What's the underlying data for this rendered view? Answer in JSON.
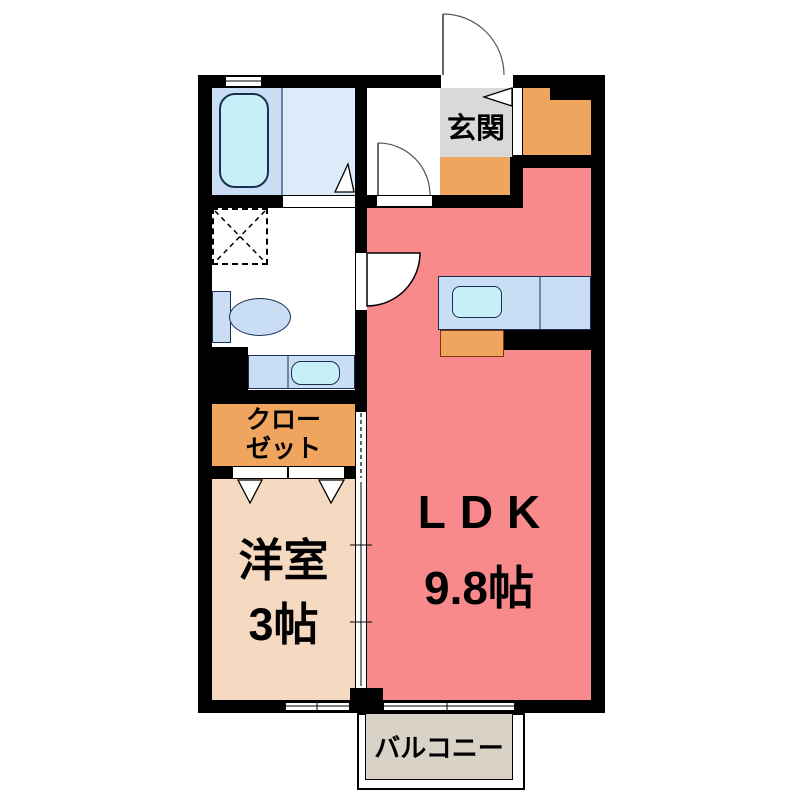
{
  "floorplan": {
    "labels": {
      "entrance": "玄関",
      "closet_line1": "クロー",
      "closet_line2": "ゼット",
      "western_line1": "洋室",
      "western_line2": "3帖",
      "ldk_line1": "LDK",
      "ldk_line2": "9.8帖",
      "balcony": "バルコニー"
    },
    "rooms": [
      {
        "name": "玄関"
      },
      {
        "name": "クローゼット"
      },
      {
        "name": "洋室",
        "size": "3帖"
      },
      {
        "name": "LDK",
        "size": "9.8帖"
      },
      {
        "name": "バルコニー"
      }
    ],
    "fixtures": [
      "bathtub",
      "washing-machine-pan",
      "toilet",
      "washbasin",
      "kitchen-counter",
      "kitchen-sink",
      "shoe-storage",
      "entrance-door",
      "hall-door",
      "washroom-door",
      "closet-folding-doors",
      "sliding-door",
      "windows"
    ],
    "colors": {
      "wall": "#000000",
      "ldk": "#f98a8b",
      "western_room": "#f5d9c0",
      "closet": "#f0a55e",
      "entrance_floor": "#d9d9d9",
      "bathroom": "#dcebfa",
      "bathtub_area": "#c9ddf5",
      "fixture": "#c9ddf5",
      "water": "#c6eff8",
      "balcony": "#d9d3c7"
    }
  }
}
